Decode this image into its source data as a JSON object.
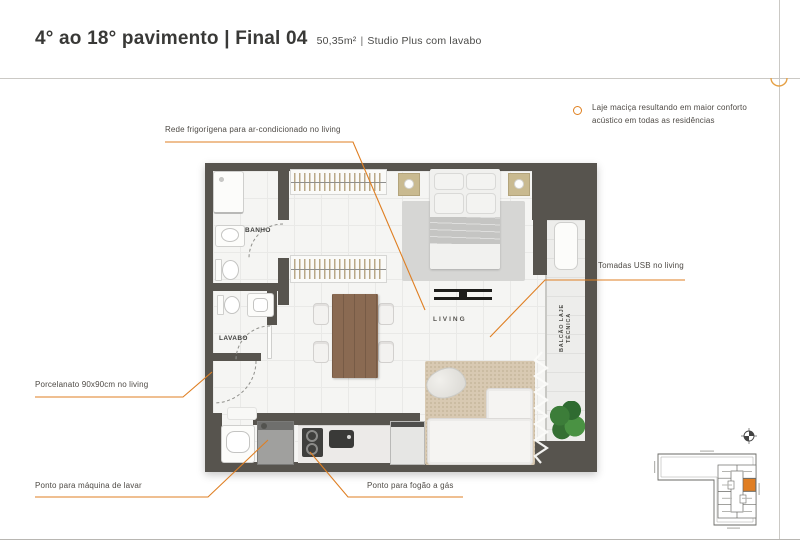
{
  "header": {
    "title": "4° ao 18° pavimento | Final 04",
    "area": "50,35m²",
    "separator": "|",
    "unit_type": "Studio Plus com lavabo"
  },
  "note": {
    "line1": "Laje maciça resultando em maior conforto",
    "line2": "acústico em todas as residências"
  },
  "annotations": {
    "ac": "Rede frigorígena para ar-condicionado no living",
    "usb": "Tomadas USB no living",
    "floor": "Porcelanato 90x90cm no living",
    "washer": "Ponto para máquina de lavar",
    "stove": "Ponto para fogão a gás"
  },
  "rooms": {
    "bath": "BANHO",
    "lavatory": "LAVABO",
    "living": "LIVING",
    "balcony_line1": "BALCÃO LAJE",
    "balcony_line2": "TÉCNICA"
  },
  "colors": {
    "accent": "#E0801F",
    "wall": "#57544E"
  }
}
